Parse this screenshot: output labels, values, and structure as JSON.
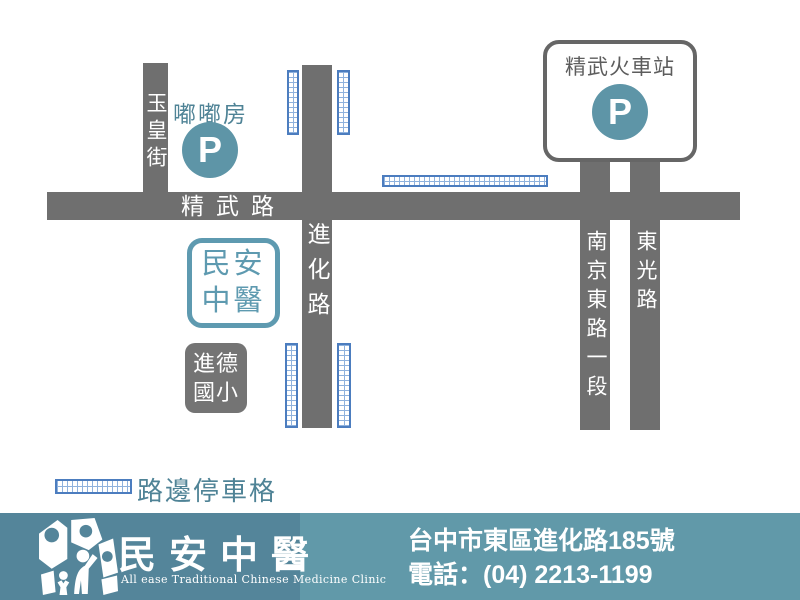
{
  "map": {
    "roads": {
      "jingwu": {
        "label": "精武路"
      },
      "yuhuang": {
        "label": "玉皇街"
      },
      "jinhua": {
        "label": "進化路"
      },
      "nanjing": {
        "label": "南京東路一段"
      },
      "dongguang": {
        "label": "東光路"
      }
    },
    "landmarks": {
      "dudufang": {
        "label": "嘟嘟房",
        "parking_symbol": "P"
      },
      "station": {
        "label": "精武火車站",
        "parking_symbol": "P"
      },
      "clinic": {
        "line1": "民安",
        "line2": "中醫"
      },
      "school": {
        "line1": "進德",
        "line2": "國小"
      }
    },
    "legend": {
      "label": "路邊停車格"
    }
  },
  "footer": {
    "logo_title": "民安中醫",
    "logo_subtitle": "All ease Traditional Chinese Medicine Clinic",
    "address": "台中市東區進化路185號",
    "phone": "電話：(04) 2213-1199"
  },
  "colors": {
    "road_gray": "#6f6f6f",
    "teal_accent": "#5e95a7",
    "teal_text": "#4f8396",
    "clinic_teal": "#5e9ab0",
    "parking_blue": "#4c7dbf",
    "footer_left_teal": "#54859a",
    "footer_right_teal": "#6199a9"
  }
}
